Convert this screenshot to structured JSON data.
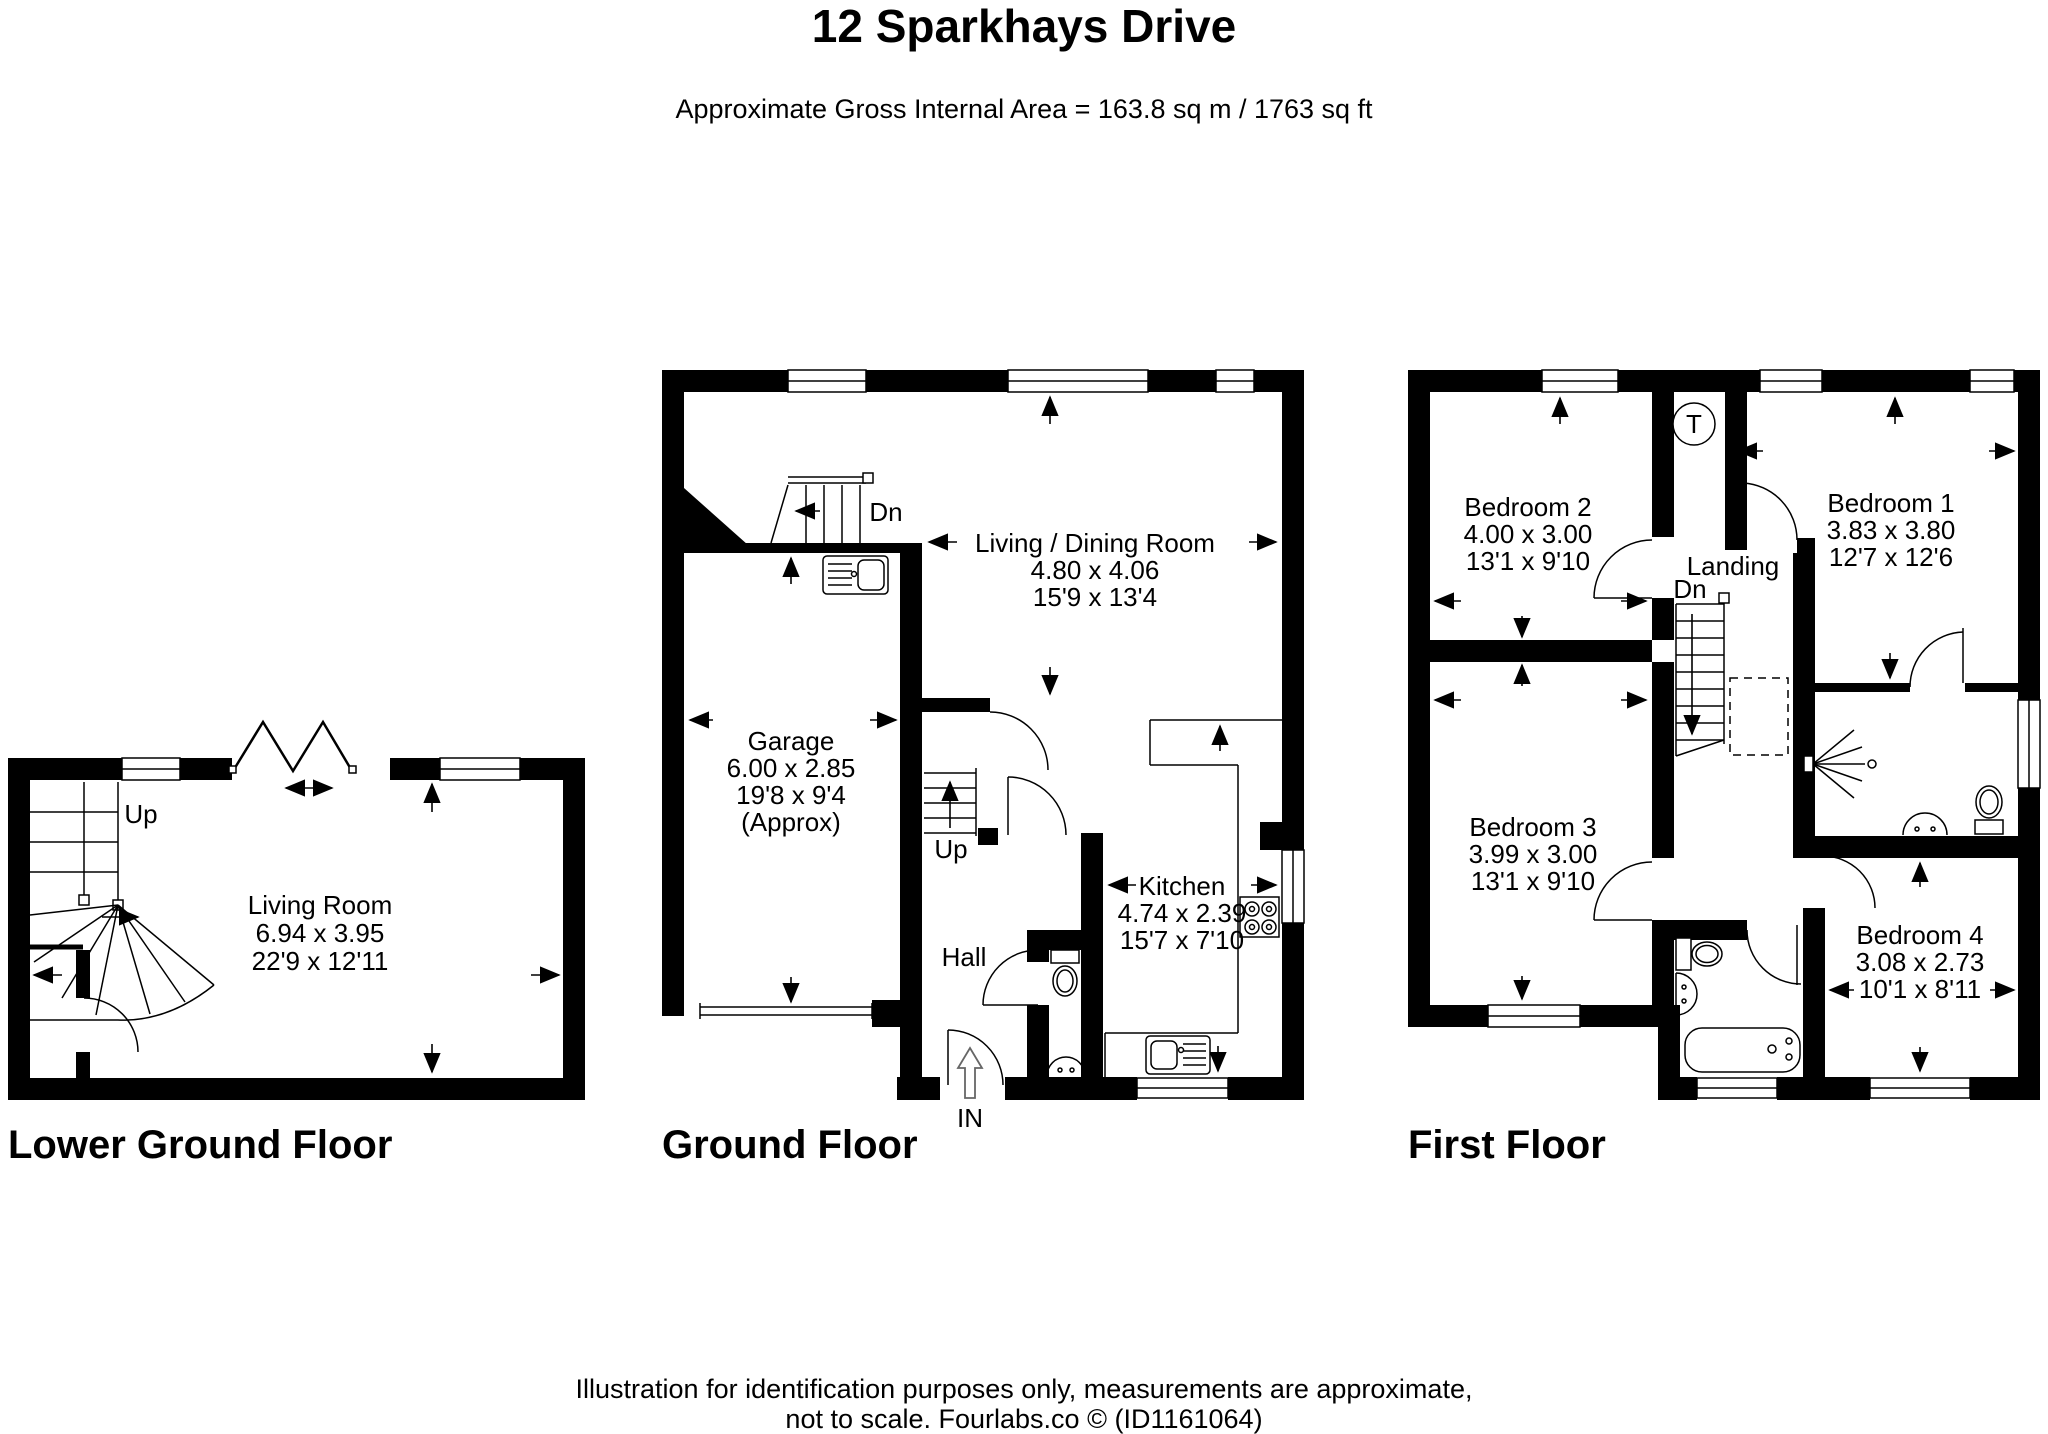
{
  "page": {
    "title": "12 Sparkhays Drive",
    "subtitle": "Approximate Gross Internal Area = 163.8 sq m / 1763 sq ft",
    "footer_line1": "Illustration for identification purposes only, measurements are approximate,",
    "footer_line2": "not to scale. Fourlabs.co © (ID1161064)"
  },
  "floors": {
    "lower_ground": {
      "label": "Lower Ground Floor",
      "rooms": {
        "living_room": {
          "name": "Living Room",
          "metric": "6.94 x 3.95",
          "imperial": "22'9 x 12'11"
        }
      },
      "annotations": {
        "up": "Up"
      }
    },
    "ground": {
      "label": "Ground Floor",
      "rooms": {
        "garage": {
          "name": "Garage",
          "metric": "6.00 x 2.85",
          "imperial": "19'8 x 9'4",
          "note": "(Approx)"
        },
        "living_dining": {
          "name": "Living / Dining Room",
          "metric": "4.80 x 4.06",
          "imperial": "15'9 x 13'4"
        },
        "kitchen": {
          "name": "Kitchen",
          "metric": "4.74 x 2.39",
          "imperial": "15'7 x 7'10"
        },
        "hall": {
          "name": "Hall"
        }
      },
      "annotations": {
        "dn": "Dn",
        "up": "Up",
        "entrance": "IN"
      }
    },
    "first": {
      "label": "First Floor",
      "rooms": {
        "bedroom_1": {
          "name": "Bedroom 1",
          "metric": "3.83 x 3.80",
          "imperial": "12'7 x 12'6"
        },
        "bedroom_2": {
          "name": "Bedroom 2",
          "metric": "4.00 x 3.00",
          "imperial": "13'1 x 9'10"
        },
        "bedroom_3": {
          "name": "Bedroom 3",
          "metric": "3.99 x 3.00",
          "imperial": "13'1 x 9'10"
        },
        "bedroom_4": {
          "name": "Bedroom 4",
          "metric": "3.08 x 2.73",
          "imperial": "10'1 x 8'11"
        },
        "landing": {
          "name": "Landing"
        }
      },
      "annotations": {
        "dn": "Dn",
        "tank": "T"
      }
    }
  },
  "colors": {
    "wall": "#000000",
    "line": "#000000",
    "background": "#ffffff"
  }
}
